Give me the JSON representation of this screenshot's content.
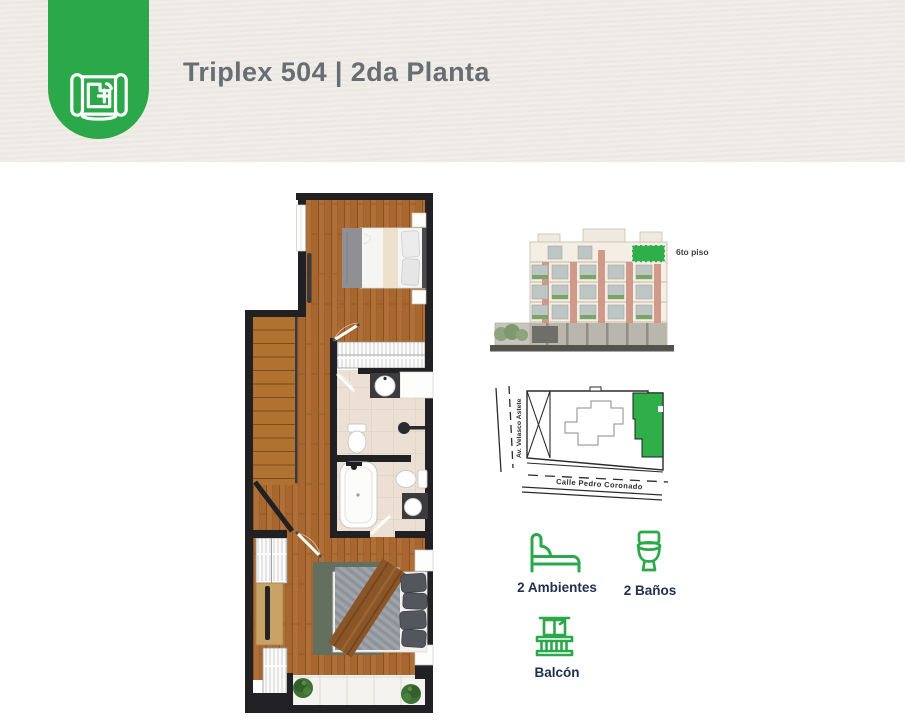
{
  "header": {
    "title": "Triplex 504 | 2da Planta",
    "badge_icon": "blueprint-icon"
  },
  "elevation": {
    "floor_label": "6to piso"
  },
  "site_map": {
    "street_left": "Av. Velasco Astete",
    "street_bottom": "Calle Pedro Coronado"
  },
  "features": [
    {
      "icon": "bed-icon",
      "label": "2 Ambientes"
    },
    {
      "icon": "toilet-icon",
      "label": "2 Baños"
    },
    {
      "icon": "balcony-icon",
      "label": "Balcón"
    }
  ],
  "colors": {
    "accent_green": "#2BA84A",
    "map_highlight_green": "#2FAE49",
    "header_background": "#ECE9E2",
    "title_gray": "#696E75",
    "label_navy": "#22304E",
    "plan_wall_black": "#212123",
    "wood_floor": "#A8672E"
  }
}
